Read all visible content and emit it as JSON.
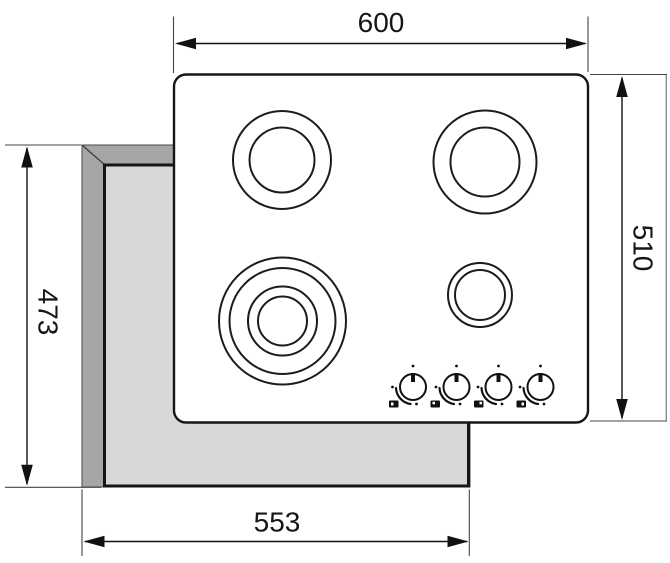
{
  "diagram": {
    "type": "technical-installation-drawing",
    "subject": "built-in cooktop (hob) with four burners and cutout dimensions"
  },
  "dimensions": {
    "top": {
      "label": "600"
    },
    "right": {
      "label": "510"
    },
    "left": {
      "label": "473"
    },
    "bottom": {
      "label": "553"
    }
  },
  "colors": {
    "background": "#ffffff",
    "line": "#161616",
    "worktop_edge": "#a6a6a6",
    "cutout_fill": "#d8d8d8",
    "hob_fill": "#ffffff"
  },
  "knobs": [
    {
      "icon": "burner-position-front-left-icon"
    },
    {
      "icon": "burner-position-back-left-icon"
    },
    {
      "icon": "burner-position-back-right-icon"
    },
    {
      "icon": "burner-position-front-right-icon"
    }
  ]
}
